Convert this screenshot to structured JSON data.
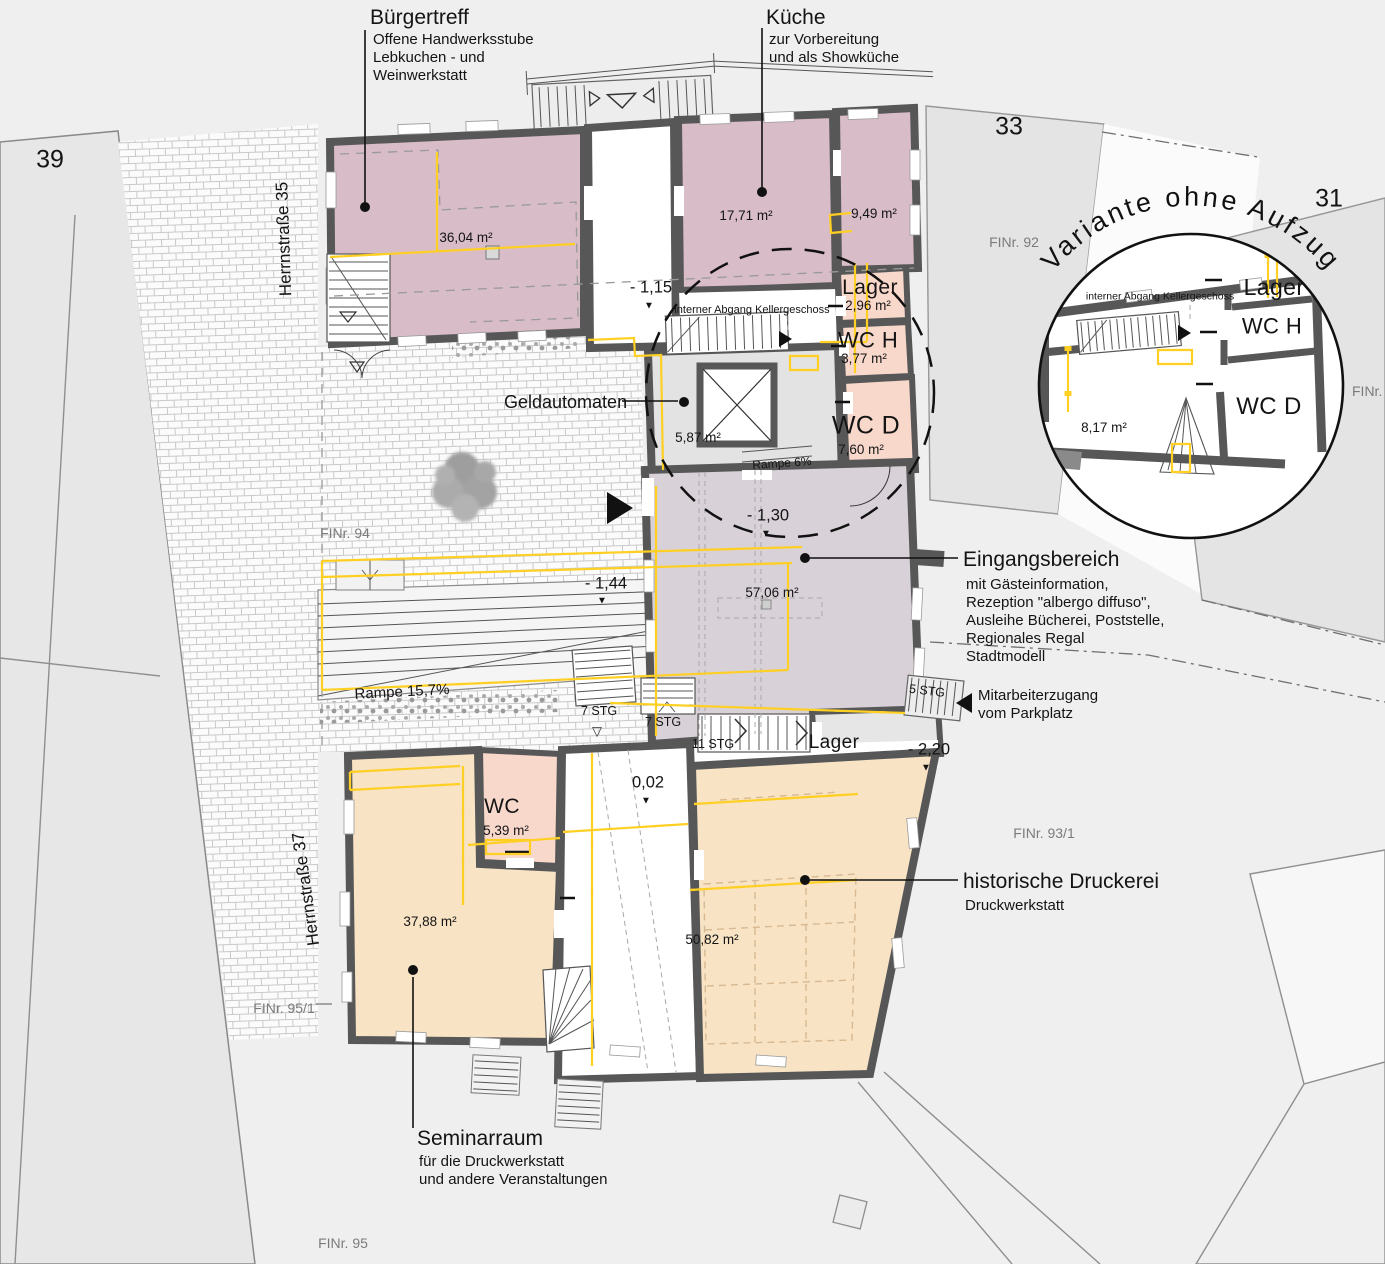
{
  "colors": {
    "room_pink": "#d8bcc7",
    "room_salmon": "#f9d8cc",
    "room_lavender": "#d8d1d8",
    "room_orange": "#f8e3c5",
    "room_gray": "#e3e3e3",
    "room_gray2": "#e6e6e6",
    "wall": "#575757",
    "line_yellow": "#ffd023"
  },
  "glyphs": {
    "down_triangle": "▼",
    "open_down_triangle": "▽"
  },
  "annotations": {
    "buergertreff": {
      "title": "Bürgertreff",
      "desc": "Offene Handwerksstube\nLebkuchen - und\nWeinwerkstatt"
    },
    "kueche": {
      "title": "Küche",
      "desc": "zur Vorbereitung\nund als Showküche"
    },
    "eingangsbereich": {
      "title": "Eingangsbereich",
      "desc": "mit Gästeinformation,\nRezeption \"albergo diffuso\",\nAusleihe Bücherei, Poststelle,\nRegionales Regal\nStadtmodell"
    },
    "druckerei": {
      "title": "historische Druckerei",
      "desc": "Druckwerkstatt"
    },
    "seminarraum": {
      "title": "Seminarraum",
      "desc": "für die Druckwerkstatt\nund andere Veranstaltungen"
    },
    "geldautomaten": "Geldautomaten",
    "mitarbeiterzugang": "Mitarbeiterzugang\nvom Parkplatz",
    "interner_abgang": "interner Abgang\nKellergeschoss"
  },
  "rooms": {
    "buergertreff_area": "36,04 m²",
    "kueche_area": "17,71 m²",
    "nebenraum_area": "9,49 m²",
    "lager_nord": {
      "name": "Lager",
      "area": "2,96 m²"
    },
    "wc_h": {
      "name": "WC H",
      "area": "3,77 m²"
    },
    "wc_d": {
      "name": "WC D",
      "area": "7,60 m²"
    },
    "aufzug_lobby_area": "5,87 m²",
    "eingangsbereich_area": "57,06 m²",
    "lager_sued": "Lager",
    "wc_sued": {
      "name": "WC",
      "area": "5,39 m²"
    },
    "seminarraum_area": "37,88 m²",
    "druckerei_area": "50,82 m²"
  },
  "levels": {
    "l115": "- 1,15",
    "l130": "- 1,30",
    "l144": "- 1,44",
    "l220": "- 2,20",
    "l002": "0,02"
  },
  "stairs": {
    "stg7_hof": "7 STG",
    "stg7_innen": "7 STG",
    "stg11": "11 STG",
    "stg5": "5 STG"
  },
  "rampen": {
    "rampe6": "Rampe 6%",
    "rampe157": "Rampe 15,7%"
  },
  "parzellen": {
    "nr39": "39",
    "nr33": "33",
    "nr31": "31",
    "finr92": "FINr. 92",
    "finr94": "FINr. 94",
    "finr93_1": "FINr. 93/1",
    "finr95_1": "FINr. 95/1",
    "finr95": "FINr. 95",
    "finr9": "FINr. 9"
  },
  "strassen": {
    "herrnstrasse35": "Herrnstraße 35",
    "herrnstrasse37": "Herrnstraße 37"
  },
  "inset": {
    "title": "Variante ohne Aufzug",
    "interner_abgang": "interner Abgang\nKellergeschoss",
    "lager": "Lager",
    "wc_h": "WC H",
    "wc_d": "WC D",
    "area": "8,17 m²"
  }
}
